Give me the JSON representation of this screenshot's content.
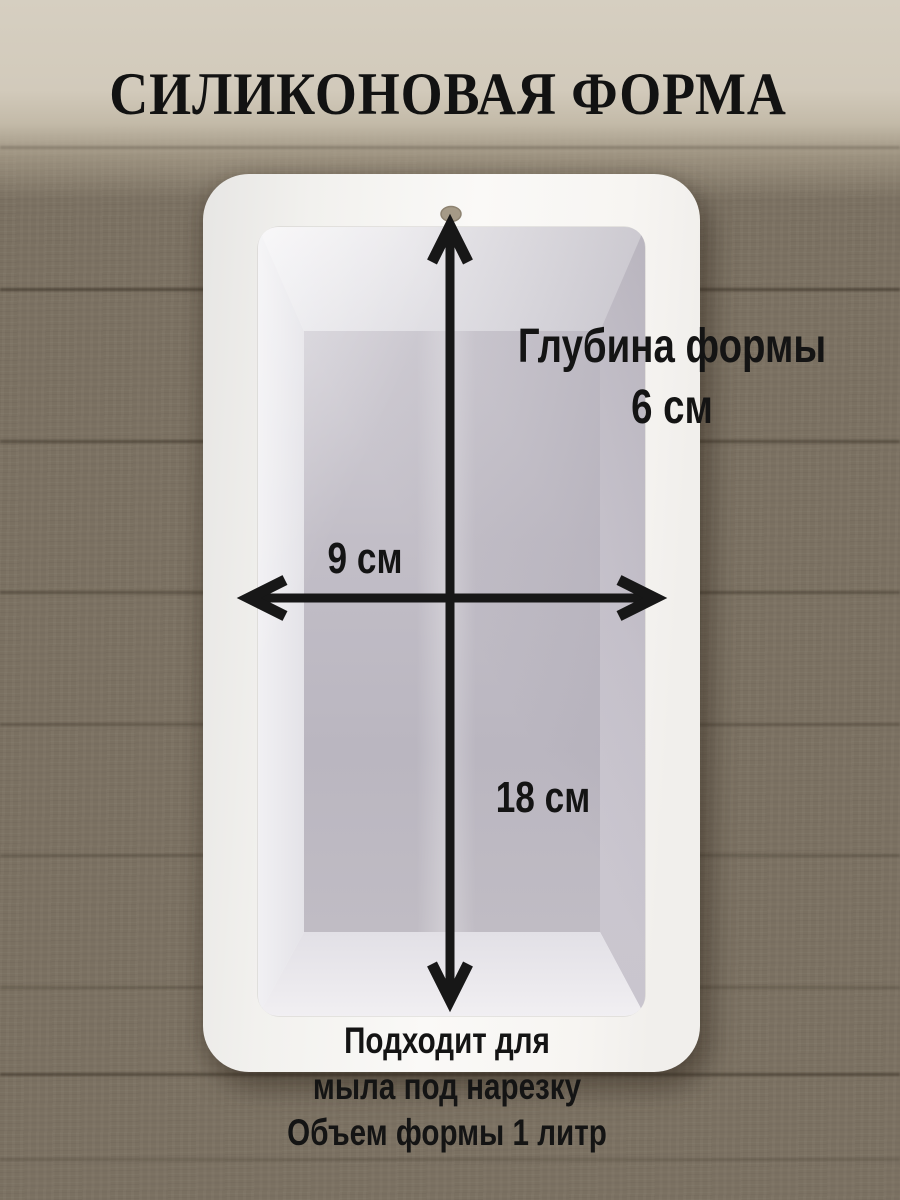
{
  "title": "СИЛИКОНОВАЯ ФОРМА",
  "labels": {
    "depth": {
      "line1": "Глубина формы",
      "line2": "6 см"
    },
    "width": "9 см",
    "height": "18 см",
    "footer": {
      "line1": "Подходит для",
      "line2": "мыла под нарезку",
      "line3": "Объем формы 1 литр"
    }
  },
  "colors": {
    "title-color": "#121212",
    "annotation-color": "#141414",
    "arrow-color": "#171717",
    "mold-white": "#f6f5f3",
    "cavity-floor-gray": "#bcb8c1",
    "wood-dark": "#52493c",
    "wood-light": "#a39987",
    "top-band-beige": "#d4cdbe",
    "hole-tan": "#a59a87"
  }
}
